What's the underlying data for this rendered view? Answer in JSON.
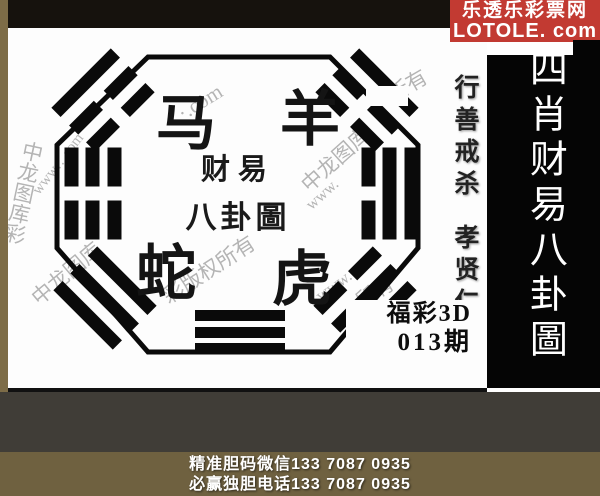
{
  "site": {
    "name_cn": "乐透乐彩票网",
    "domain": "LOTOLE. com",
    "brand_color": "#c23a32"
  },
  "panel": {
    "title": "四肖财易八卦圖"
  },
  "motto": {
    "line1": "行善戒杀",
    "line2": "孝贤仁义"
  },
  "zodiac": {
    "top_left": "马",
    "top_right": "羊",
    "bottom_left": "蛇",
    "bottom_right": "虎"
  },
  "center_seal": {
    "line1": "财易",
    "line2": "八卦圖"
  },
  "issue": {
    "game": "福彩3D",
    "period": "013期"
  },
  "footer": {
    "line1": "精准胆码微信133 7087 0935",
    "line2": "必赢独胆电话133 7087 0935"
  },
  "watermarks": [
    {
      "text": "中龙图库彩",
      "x": 0,
      "y": 112,
      "rot": 12,
      "size": 21,
      "vert": true
    },
    {
      "text": "www…com",
      "x": 14,
      "y": 128,
      "rot": -52,
      "size": 15,
      "vert": false
    },
    {
      "text": "·.com",
      "x": 168,
      "y": 62,
      "rot": -32,
      "size": 21,
      "vert": false
    },
    {
      "text": "中龙图库",
      "x": 285,
      "y": 116,
      "rot": -42,
      "size": 21,
      "vert": false
    },
    {
      "text": "www.",
      "x": 296,
      "y": 158,
      "rot": -42,
      "size": 16,
      "vert": false
    },
    {
      "text": "所有",
      "x": 378,
      "y": 42,
      "rot": -30,
      "size": 21,
      "vert": false
    },
    {
      "text": "彩版权所有",
      "x": 148,
      "y": 226,
      "rot": -33,
      "size": 21,
      "vert": false
    },
    {
      "text": "中龙图库",
      "x": 16,
      "y": 230,
      "rot": -40,
      "size": 21,
      "vert": false
    },
    {
      "text": "www.",
      "x": 306,
      "y": 248,
      "rot": -36,
      "size": 17,
      "vert": false
    },
    {
      "text": "所有",
      "x": 346,
      "y": 248,
      "rot": -30,
      "size": 20,
      "vert": false
    }
  ],
  "trigrams": [
    {
      "name": "top-left",
      "x": 53,
      "y": 41,
      "w": 84,
      "h": 62,
      "rot": -45,
      "bar": 13,
      "lines": [
        "solid",
        "broken",
        "broken"
      ]
    },
    {
      "name": "top-right",
      "x": 317,
      "y": 41,
      "w": 84,
      "h": 62,
      "rot": 45,
      "bar": 13,
      "lines": [
        "solid",
        "broken",
        "broken"
      ]
    },
    {
      "name": "left",
      "x": 39,
      "y": 137,
      "w": 92,
      "h": 57,
      "rot": 90,
      "bar": 14,
      "lines": [
        "broken",
        "broken",
        "broken"
      ]
    },
    {
      "name": "right",
      "x": 336,
      "y": 137,
      "w": 92,
      "h": 57,
      "rot": 90,
      "bar": 14,
      "lines": [
        "solid",
        "solid",
        "broken"
      ]
    },
    {
      "name": "bottom-left",
      "x": 55,
      "y": 239,
      "w": 84,
      "h": 62,
      "rot": 45,
      "bar": 13,
      "lines": [
        "solid",
        "solid",
        "solid"
      ]
    },
    {
      "name": "bottom-right",
      "x": 315,
      "y": 239,
      "w": 84,
      "h": 62,
      "rot": -45,
      "bar": 13,
      "lines": [
        "broken",
        "solid",
        "solid"
      ]
    },
    {
      "name": "bottom",
      "x": 187,
      "y": 282,
      "w": 90,
      "h": 44,
      "rot": 0,
      "bar": 11,
      "lines": [
        "solid",
        "solid",
        "solid"
      ]
    }
  ]
}
